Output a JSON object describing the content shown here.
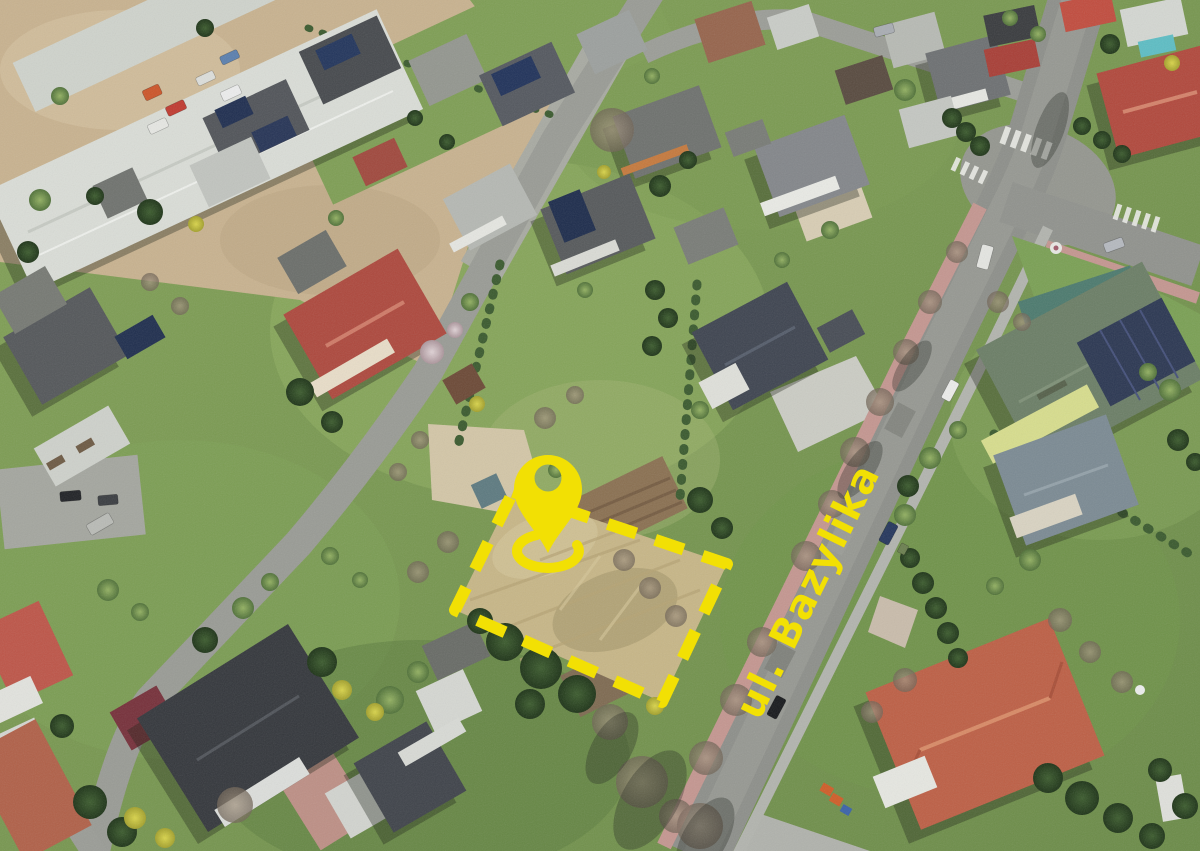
{
  "scene": {
    "street_label": "ul. Bazylika",
    "accent_color": "#F2E004",
    "marker_icon": "location-pin-icon",
    "plot_outline": "yellow-dashed-plot-boundary"
  }
}
